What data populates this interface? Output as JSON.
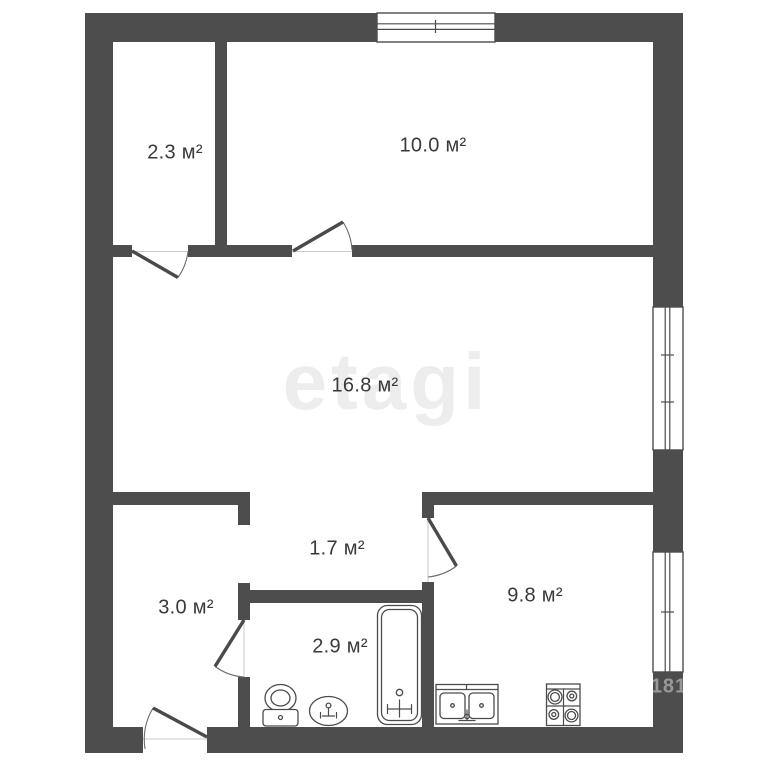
{
  "plan": {
    "type": "apartment-floor-plan",
    "units_suffix": "м²"
  },
  "watermark": {
    "brand": "etagi",
    "corner_code": "181"
  },
  "rooms": [
    {
      "name": "closet",
      "area_label": "2.3 м²"
    },
    {
      "name": "room-10",
      "area_label": "10.0 м²"
    },
    {
      "name": "living-room",
      "area_label": "16.8 м²"
    },
    {
      "name": "inner-hall",
      "area_label": "1.7 м²"
    },
    {
      "name": "entry-hall",
      "area_label": "3.0 м²"
    },
    {
      "name": "bathroom",
      "area_label": "2.9 м²"
    },
    {
      "name": "kitchen",
      "area_label": "9.8 м²"
    }
  ],
  "fixtures": [
    {
      "icon": "toilet-icon"
    },
    {
      "icon": "washbasin-icon"
    },
    {
      "icon": "bathtub-icon"
    },
    {
      "icon": "kitchen-sink-icon"
    },
    {
      "icon": "stove-icon"
    }
  ],
  "colors": {
    "wall": "#4d4d4d",
    "outline": "#4c4c4c",
    "label_text": "#3a3a3a",
    "background": "#ffffff"
  }
}
